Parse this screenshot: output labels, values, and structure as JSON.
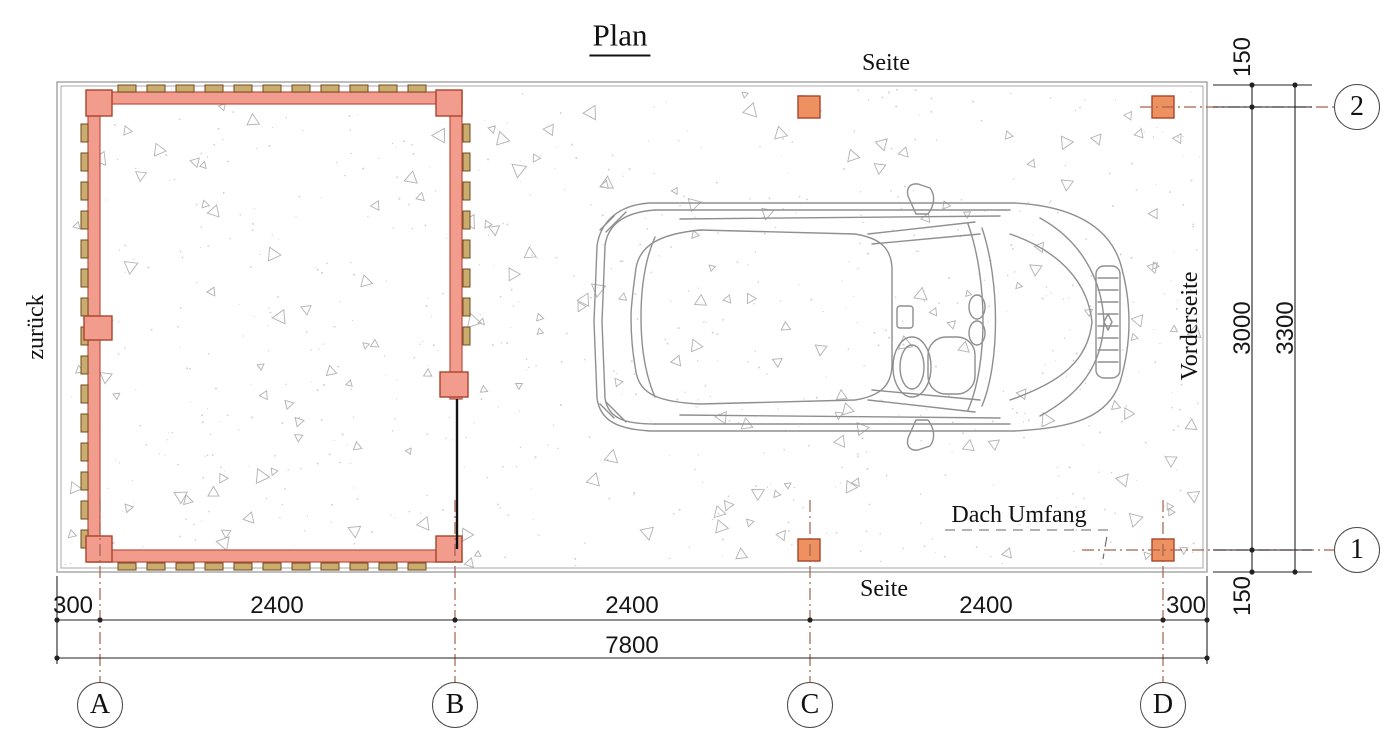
{
  "drawing": {
    "title": "Plan",
    "labels": {
      "side_top": "Seite",
      "side_bottom": "Seite",
      "front_side": "Vorderseite",
      "back_side": "zurück",
      "roof_outline": "Dach Umfang"
    },
    "grid_axes": {
      "columns": [
        "A",
        "B",
        "C",
        "D"
      ],
      "rows": [
        "1",
        "2"
      ]
    },
    "dimensions_mm": {
      "bottom_segments": [
        "300",
        "2400",
        "2400",
        "2400",
        "300"
      ],
      "bottom_total": "7800",
      "right_segments": [
        "150",
        "3000",
        "150"
      ],
      "right_total": "3300"
    },
    "colors": {
      "wall_fill": "#F19C8C",
      "wall_stroke": "#BB5243",
      "batten_fill": "#C9AC6E",
      "batten_stroke": "#6F4A1E",
      "post_fill": "#EE9160",
      "post_stroke": "#A8442B",
      "grid_line": "#A3604C",
      "dimension_line": "#222222",
      "slab_edge": "#9A9A9A",
      "car_line": "#8F8F8F",
      "texture": "#B2B2B2"
    }
  }
}
